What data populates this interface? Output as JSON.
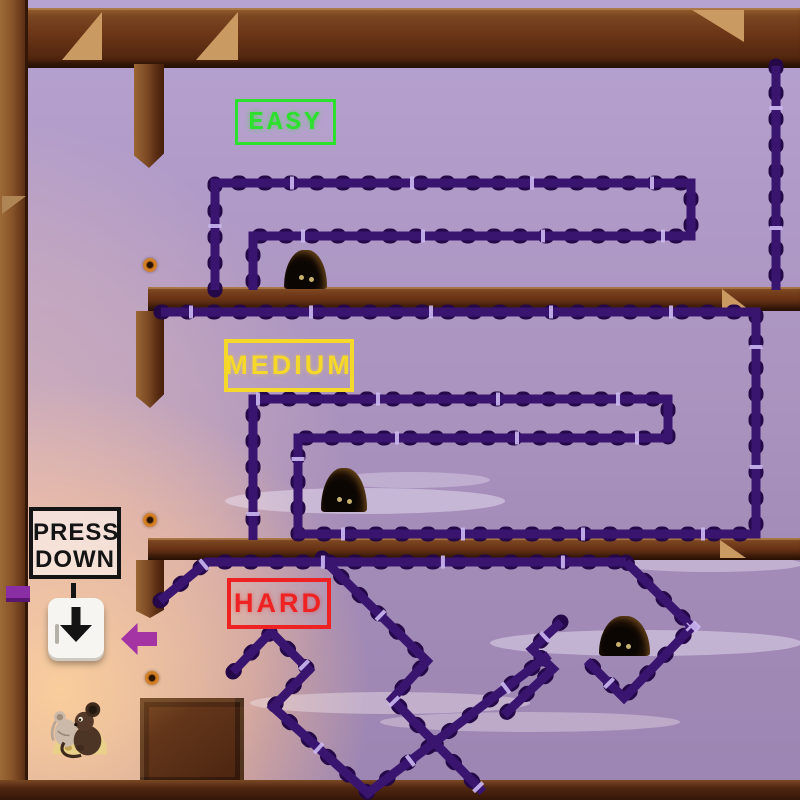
{
  "difficulty_labels": {
    "easy": "EASY",
    "medium": "MEDIUM",
    "hard": "HARD"
  },
  "instruction_sign": {
    "line1": "PRESS",
    "line2": "DOWN"
  },
  "colors": {
    "easy_green": "#2ee02e",
    "medium_yellow": "#f5d829",
    "hard_red": "#ee2222",
    "wall_purple": "#3a1570",
    "wall_bump": "#240847",
    "wall_stitch": "#cdb9f2",
    "wood_brown": "#6b3517",
    "arrow_purple": "#a434a4",
    "sign_ink": "#141414",
    "key_face": "#f7f5f1",
    "bg_top": "#b7a3d1",
    "bg_bottom": "#9c85b2",
    "glow_orange": "#ffd18d",
    "collectible_orange": "#c8731e"
  },
  "entities": {
    "mouse_hole_count": 3,
    "collectible_count": 3,
    "player_mouse_count": 2
  }
}
